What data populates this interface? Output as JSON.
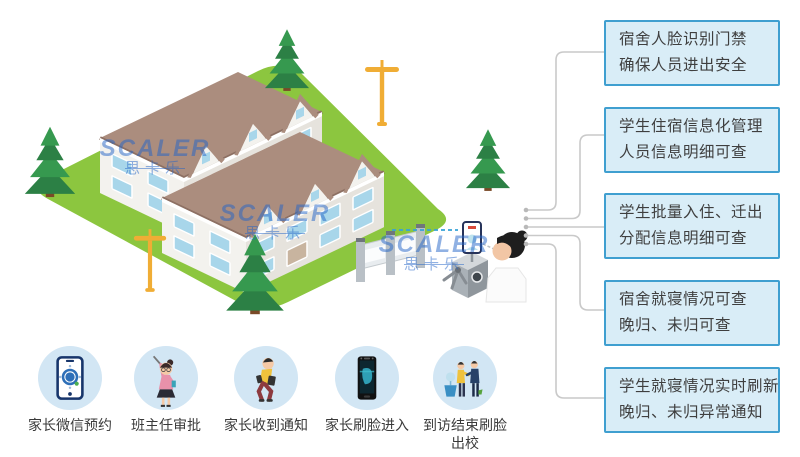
{
  "brand": {
    "name": "SCALER",
    "name_cn": "思卡乐"
  },
  "callouts": [
    {
      "line1": "宿舍人脸识别门禁",
      "line2": "确保人员进出安全"
    },
    {
      "line1": "学生住宿信息化管理",
      "line2": "人员信息明细可查"
    },
    {
      "line1": "学生批量入住、迁出",
      "line2": "分配信息明细可查"
    },
    {
      "line1": "宿舍就寝情况可查",
      "line2": "晚归、未归可查"
    },
    {
      "line1": "学生就寝情况实时刷新",
      "line2": "晚归、未归异常通知"
    }
  ],
  "steps": [
    {
      "icon": "wechat-phone-icon",
      "label": "家长微信预约"
    },
    {
      "icon": "teacher-icon",
      "label": "班主任审批"
    },
    {
      "icon": "parent-notified-icon",
      "label": "家长收到通知"
    },
    {
      "icon": "face-terminal-icon",
      "label": "家长刷脸进入"
    },
    {
      "icon": "visit-end-icon",
      "label": "到访结束刷脸出校"
    }
  ],
  "colors": {
    "box_fill": "#d9edf7",
    "box_border": "#3f9fd0",
    "text": "#3f3f3f",
    "connector": "#c9c9c9",
    "lawn_green": "#8cc63f",
    "roof_brown": "#ab8d7e",
    "window_blue": "#a8d6ea",
    "brand_blue": "#2465c8",
    "circle_bg": "#d2e6f4",
    "lamp_yellow": "#f0ad35"
  }
}
